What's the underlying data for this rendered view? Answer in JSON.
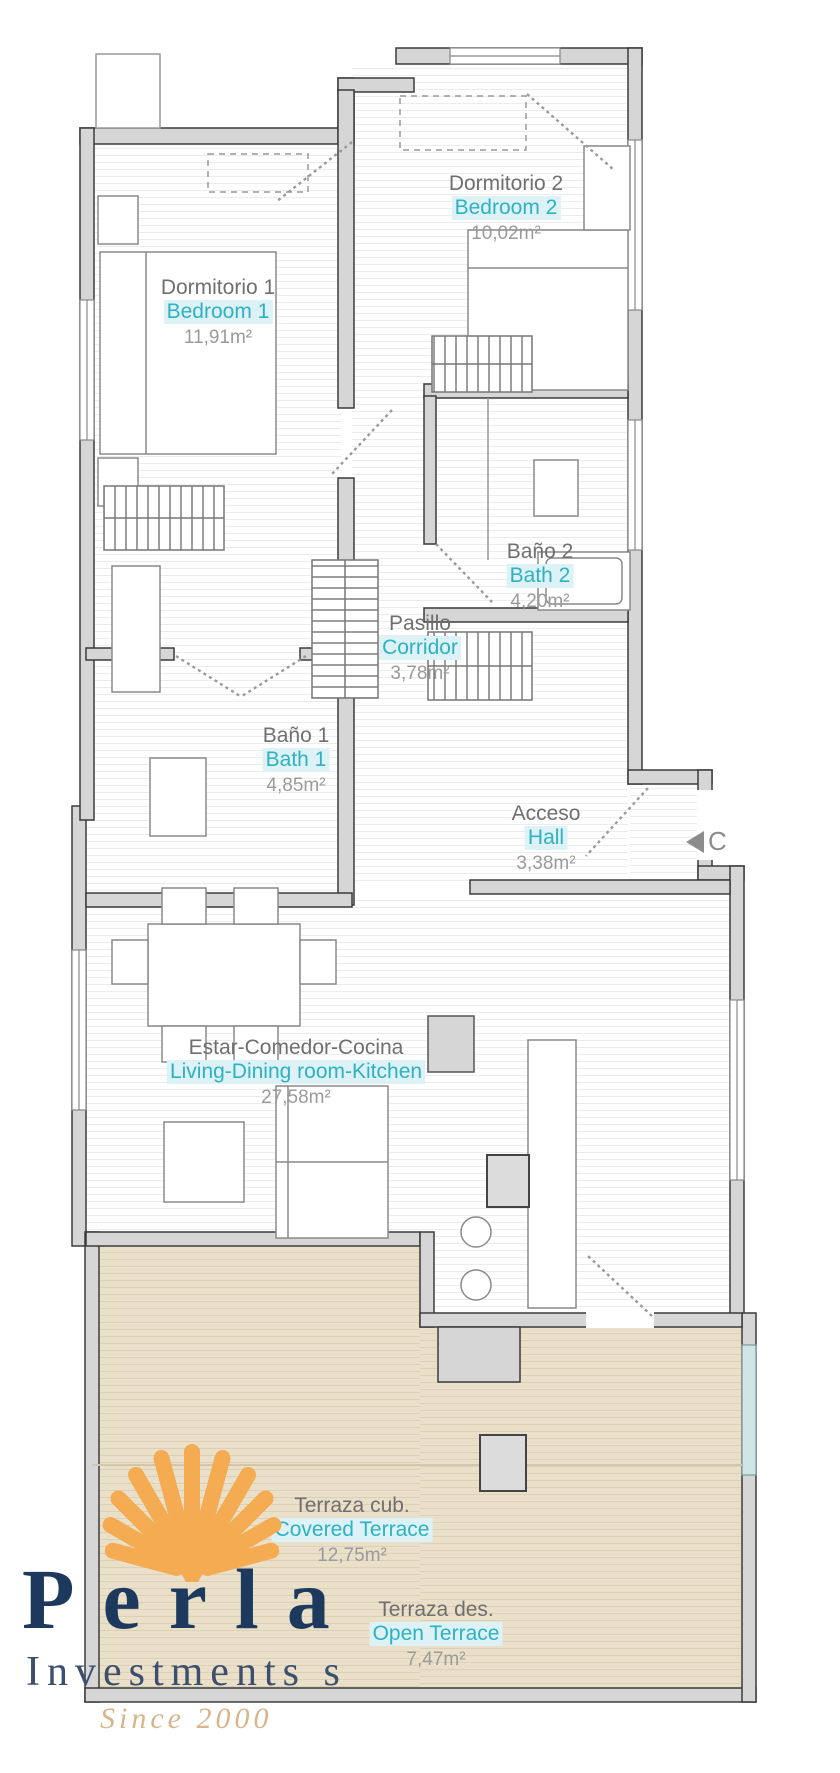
{
  "rooms": [
    {
      "name_es": "Dormitorio 1",
      "name_en": "Bedroom 1",
      "area": "11,91m²"
    },
    {
      "name_es": "Dormitorio 2",
      "name_en": "Bedroom 2",
      "area": "10,02m²"
    },
    {
      "name_es": "Baño 2",
      "name_en": "Bath 2",
      "area": "4,20m²"
    },
    {
      "name_es": "Pasillo",
      "name_en": "Corridor",
      "area": "3,78m²"
    },
    {
      "name_es": "Baño 1",
      "name_en": "Bath 1",
      "area": "4,85m²"
    },
    {
      "name_es": "Acceso",
      "name_en": "Hall",
      "area": "3,38m²"
    },
    {
      "name_es": "Estar-Comedor-Cocina",
      "name_en": "Living-Dining room-Kitchen",
      "area": "27,58m²"
    },
    {
      "name_es": "Terraza cub.",
      "name_en": "Covered Terrace",
      "area": "12,75m²"
    },
    {
      "name_es": "Terraza des.",
      "name_en": "Open Terrace",
      "area": "7,47m²"
    }
  ],
  "marker": {
    "label": "C"
  },
  "logo": {
    "brand": "Perla",
    "subtitle": "Investments s",
    "tagline": "Since 2000"
  },
  "colors": {
    "label_gray": "#6f6f6f",
    "label_teal": "#2fb1c3",
    "teal_bg": "#dcf2f6",
    "area_gray": "#9b9b9b",
    "wall_fill": "#d6d6d6",
    "wall_line": "#3b3b3b",
    "terrace_floor": "#eae0ca",
    "logo_navy": "#1d3a5e",
    "logo_tan": "#d6b58a",
    "shell_gold": "#f4ab52",
    "glass": "#cfe4e4"
  }
}
